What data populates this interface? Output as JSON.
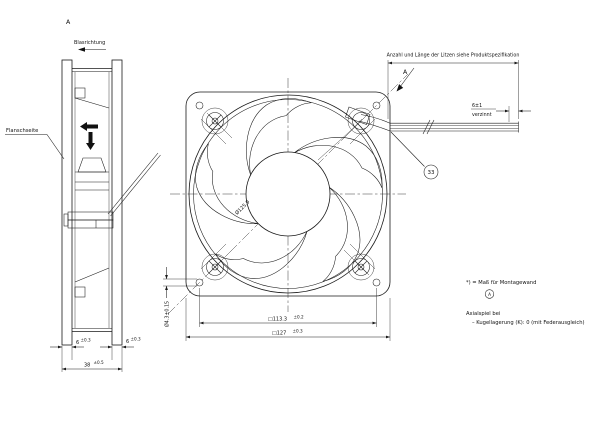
{
  "drawing": {
    "colors": {
      "line": "#1a1a1a",
      "background": "#ffffff"
    },
    "side_view": {
      "view_label": "A",
      "airflow_label": "Blasrichtung",
      "flange_label": "Flanschseite",
      "dim_flange_left": "6",
      "dim_flange_left_tol": "±0.3",
      "dim_flange_right": "6",
      "dim_flange_right_tol": "±0.3",
      "dim_depth": "38",
      "dim_depth_tol": "±0.5"
    },
    "front_view": {
      "view_arrow_label": "A",
      "dim_circle_dia": "Ø125.9",
      "dim_hole_dia": "Ø4.3±0.15",
      "dim_hole_spacing": "□113.3",
      "dim_hole_spacing_tol": "±0.2",
      "dim_outer_square": "□127",
      "dim_outer_square_tol": "±0.3"
    },
    "leads": {
      "note": "Anzahl und Länge der Litzen siehe Produktspezifikation",
      "tinned_dim": "6±1",
      "tinned_label": "verzinnt",
      "balloon_number": "33"
    },
    "notes": {
      "mounting_note": "*) = Maß für Montagewand",
      "circled_letter": "A",
      "axial_play_line1": "Axialspiel bei",
      "axial_play_line2": "–  Kugellagerung (K): 0 (mit Federausgleich)"
    }
  }
}
